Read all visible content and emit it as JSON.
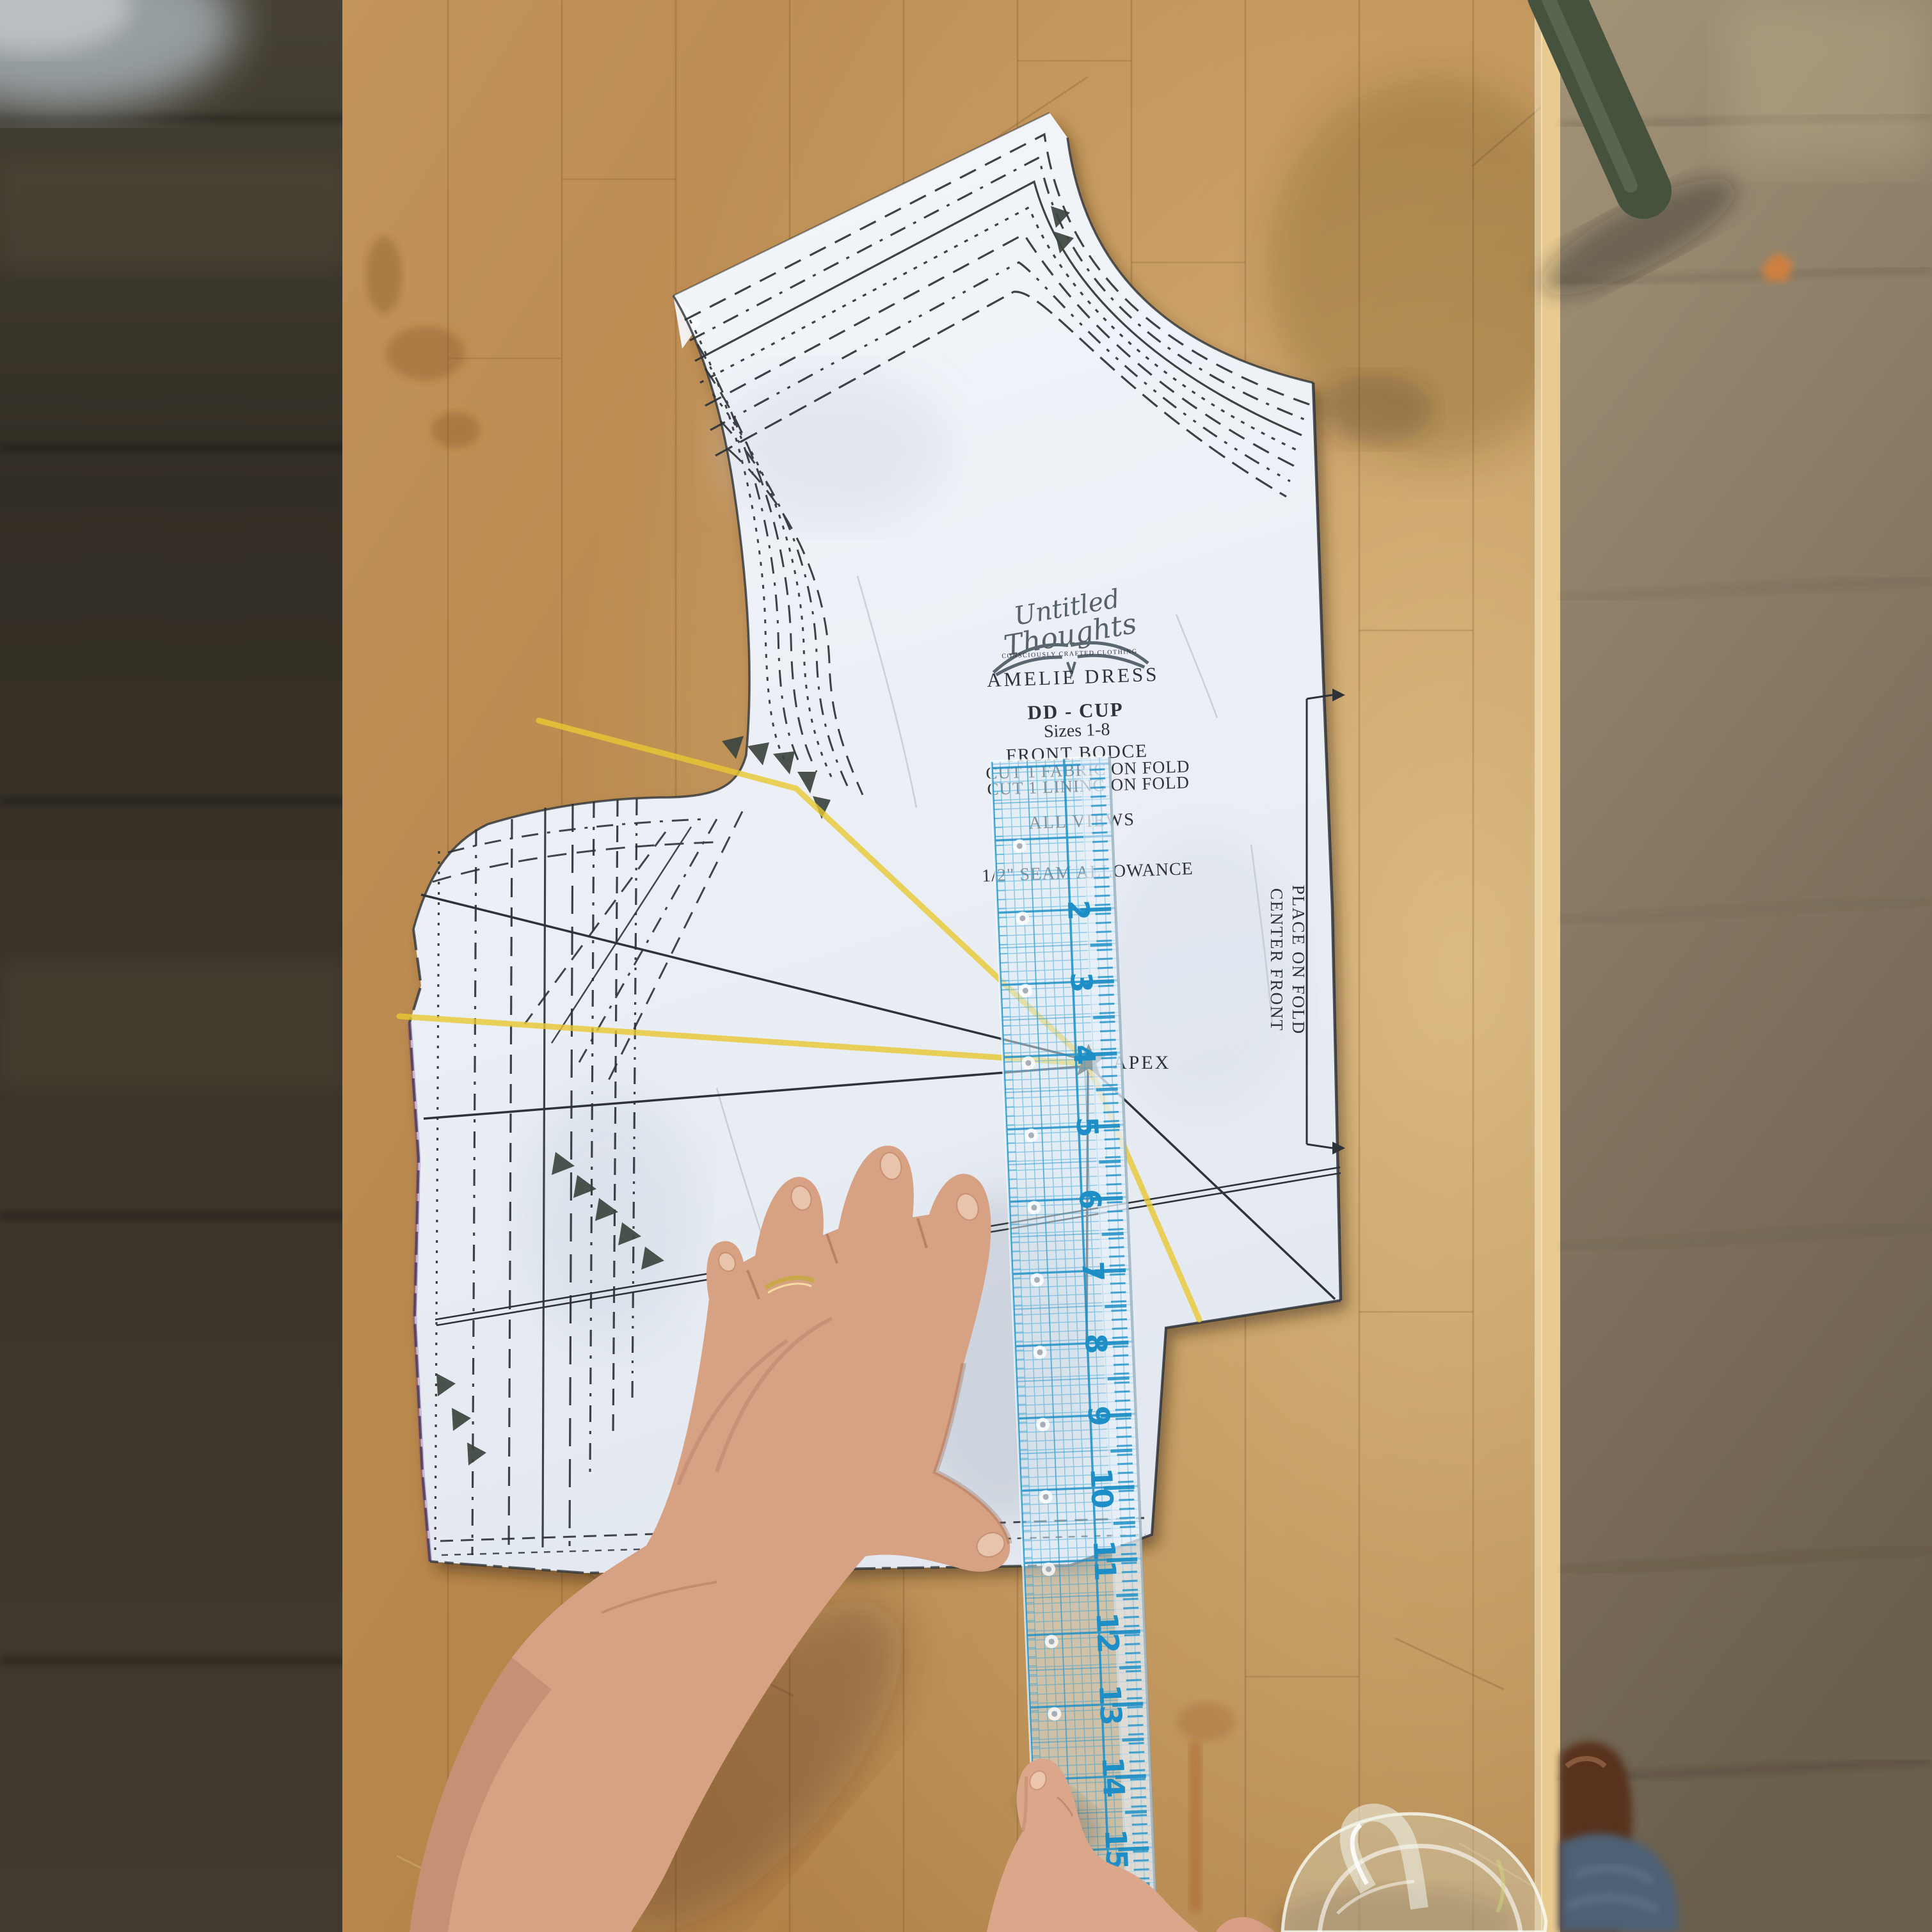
{
  "scene": {
    "description": "Overhead photograph of a sewing pattern piece on a wooden table; an adult hand presses the pattern beside a clear blue-grid ruler while a child's finger touches the ruler lower down",
    "paper_color": "#edf1f6",
    "print_color": "#2e3338",
    "highlighter_color": "#e9c832",
    "table_wood_color": "#bc8b50",
    "left_floor_color": "#3a342b",
    "right_floor_color": "#8a7b65",
    "chair_leg_color": "#46523e",
    "leaf_color": "#cd8040",
    "skin_color": "#d7a184",
    "child_skin_color": "#dca68b",
    "denim_color": "#4d6175",
    "ring_color": "#c9a84c",
    "glass_color": "rgba(220,226,210,0.35)"
  },
  "pattern_piece": {
    "brand_line1": "Untitled",
    "brand_line2": "Thoughts",
    "brand_tagline": "CONSCIOUSLY CRAFTED CLOTHING",
    "pattern_name": "AMELIE DRESS",
    "cup_label": "DD - CUP",
    "sizes_label": "Sizes  1-8",
    "piece_label": "FRONT BODCE",
    "cut_fabric": "CUT 1 FABRIC ON FOLD",
    "cut_lining": "CUT 1 LINING ON FOLD",
    "views_label": "ALL VIEWS",
    "seam_allowance": "1/2\" SEAM ALLOWANCE",
    "apex_label": "APEX",
    "fold_label_1": "CENTER FRONT",
    "fold_label_2": "PLACE ON FOLD"
  },
  "ruler": {
    "numbers": [
      "2",
      "3",
      "4",
      "5",
      "6",
      "7",
      "8",
      "9",
      "10",
      "11",
      "12",
      "13",
      "14",
      "15",
      "16"
    ],
    "grid_color": "#2b9fd4",
    "number_color": "#1d8fc6"
  }
}
